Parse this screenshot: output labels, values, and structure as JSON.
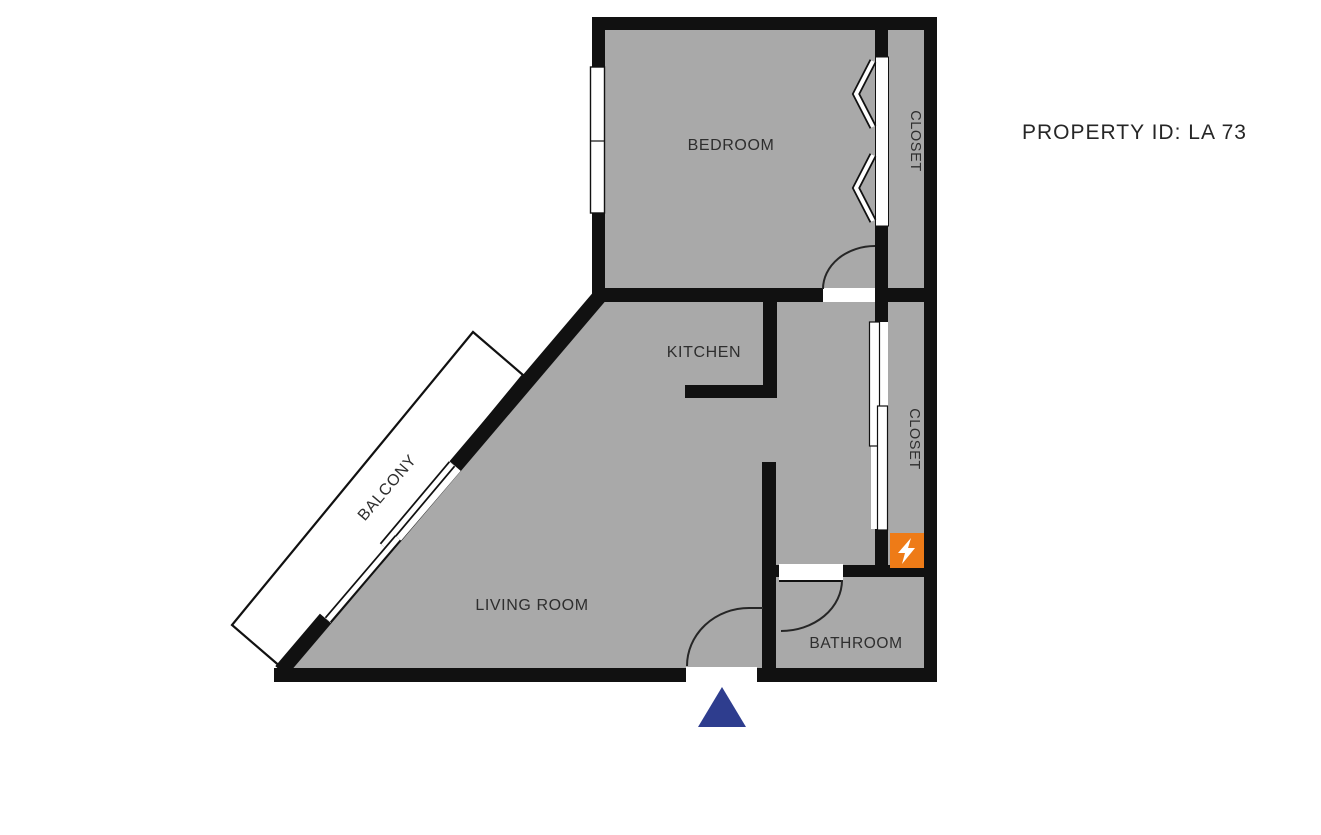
{
  "header": {
    "property_id": "PROPERTY ID: LA 73"
  },
  "rooms": {
    "bedroom": "BEDROOM",
    "kitchen": "KITCHEN",
    "living_room": "LIVING ROOM",
    "bathroom": "BATHROOM",
    "closet_bedroom": "CLOSET",
    "closet_hall": "CLOSET",
    "balcony": "BALCONY"
  },
  "icons": {
    "entrance_marker": "entrance-triangle",
    "electrical_panel": "lightning-bolt"
  },
  "colors": {
    "floor": "#a9a9a9",
    "wall": "#111111",
    "panel_orange": "#ee7b17",
    "entrance_blue": "#2e3d8e",
    "label_text": "#2e2e2e"
  }
}
